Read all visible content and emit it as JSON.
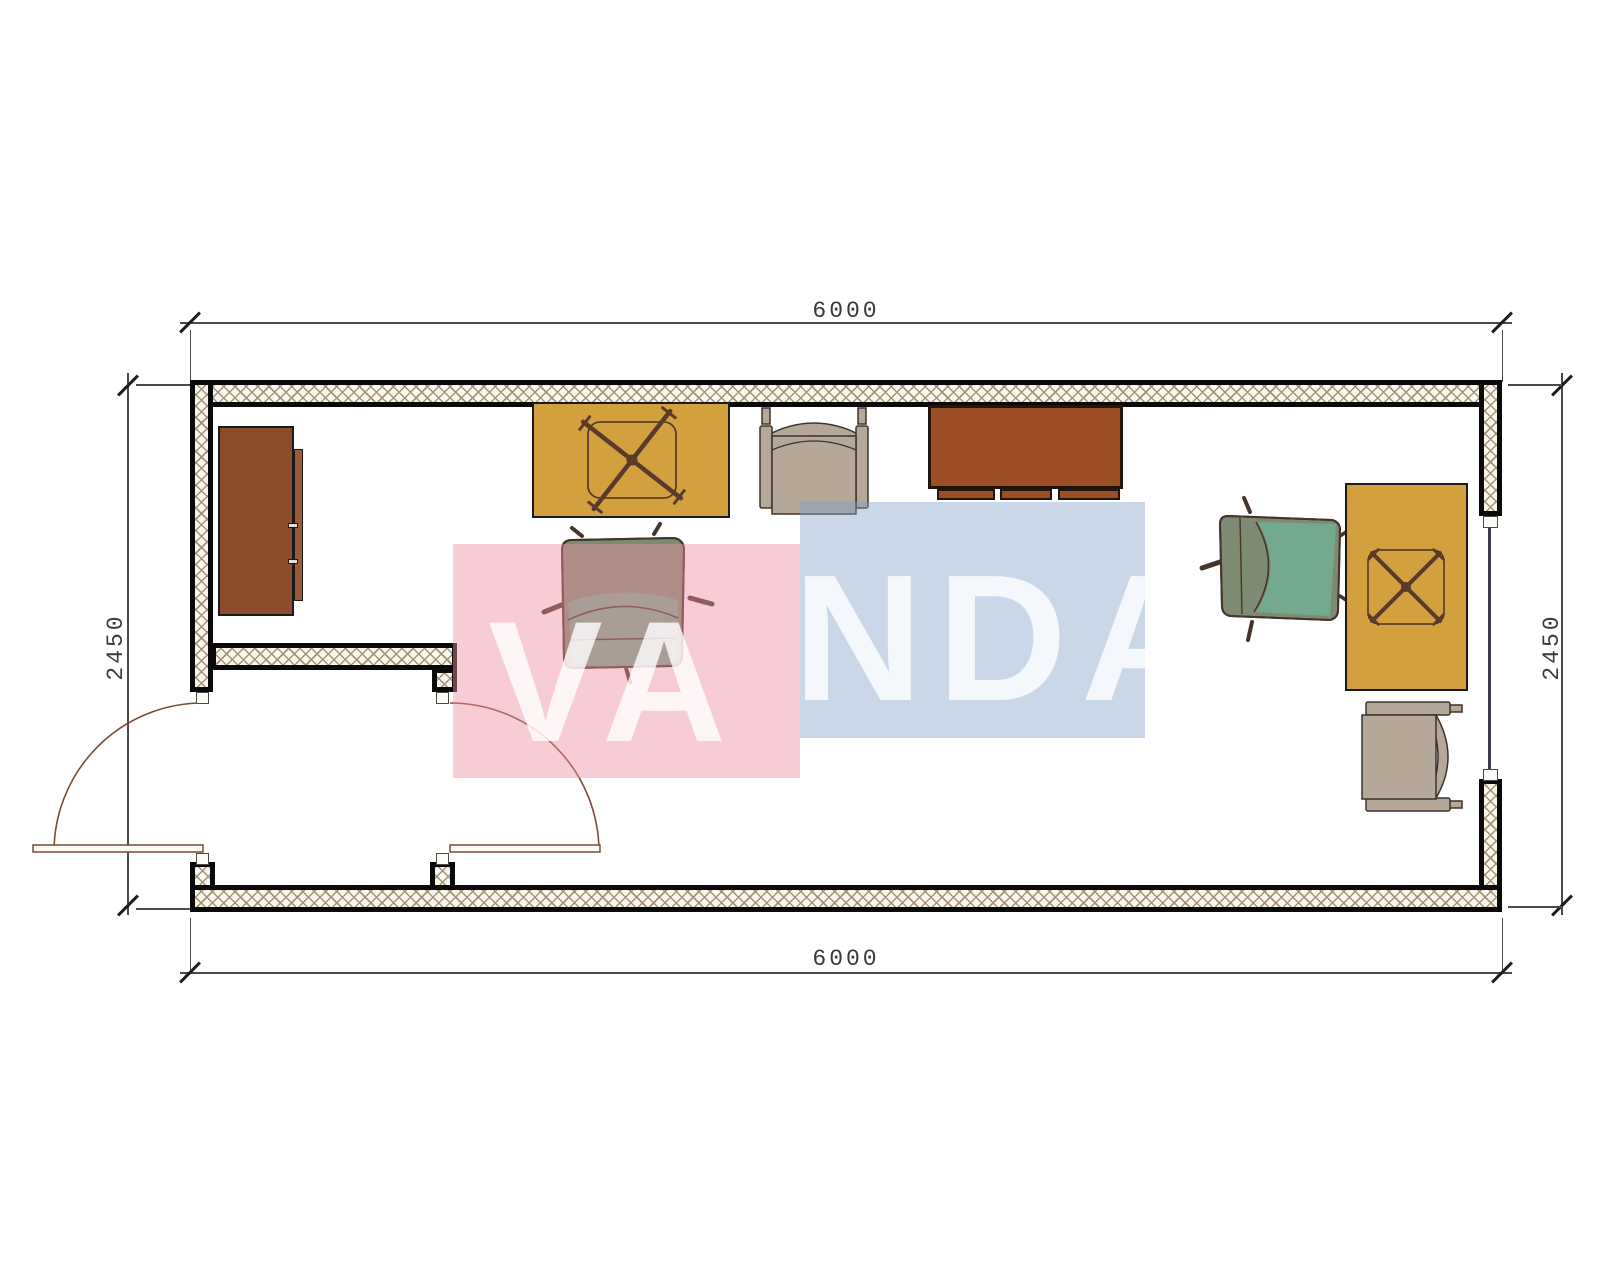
{
  "meta": {
    "drawing_type": "container-office floor plan",
    "units": "mm"
  },
  "dims": {
    "top": "6000",
    "bottom": "6000",
    "left": "2450",
    "right": "2450"
  },
  "watermark": {
    "text": "VANDA",
    "left_part": "VA",
    "right_part": "NDA",
    "pink": "#f7ccd4",
    "blue": "#c9d7e9",
    "text_color": "#ffffff"
  },
  "colors": {
    "wall-line": "#0a0a0a",
    "hatch": "#a39478",
    "hatch-bg": "#faf7ee",
    "dim-line": "#4a4a4a",
    "desk-yellow": "#d2a13e",
    "desk-brown": "#9c4e26",
    "cabinet-brown": "#8d4c2c",
    "armchair-tan": "#b6a898",
    "chair-olive": "#7e8b73",
    "chair-teal": "#72ad90",
    "chair-outline": "#46342a",
    "door-brown": "#7d4a36"
  },
  "furniture": [
    {
      "name": "wardrobe-cabinet"
    },
    {
      "name": "desk-yellow-left"
    },
    {
      "name": "office-chair-left"
    },
    {
      "name": "armchair-top"
    },
    {
      "name": "desk-brown-top"
    },
    {
      "name": "office-chair-right"
    },
    {
      "name": "desk-yellow-right"
    },
    {
      "name": "armchair-right"
    }
  ],
  "openings": [
    {
      "name": "entry-door-left-wall"
    },
    {
      "name": "interior-door-vestibule"
    },
    {
      "name": "window-right-wall"
    }
  ]
}
